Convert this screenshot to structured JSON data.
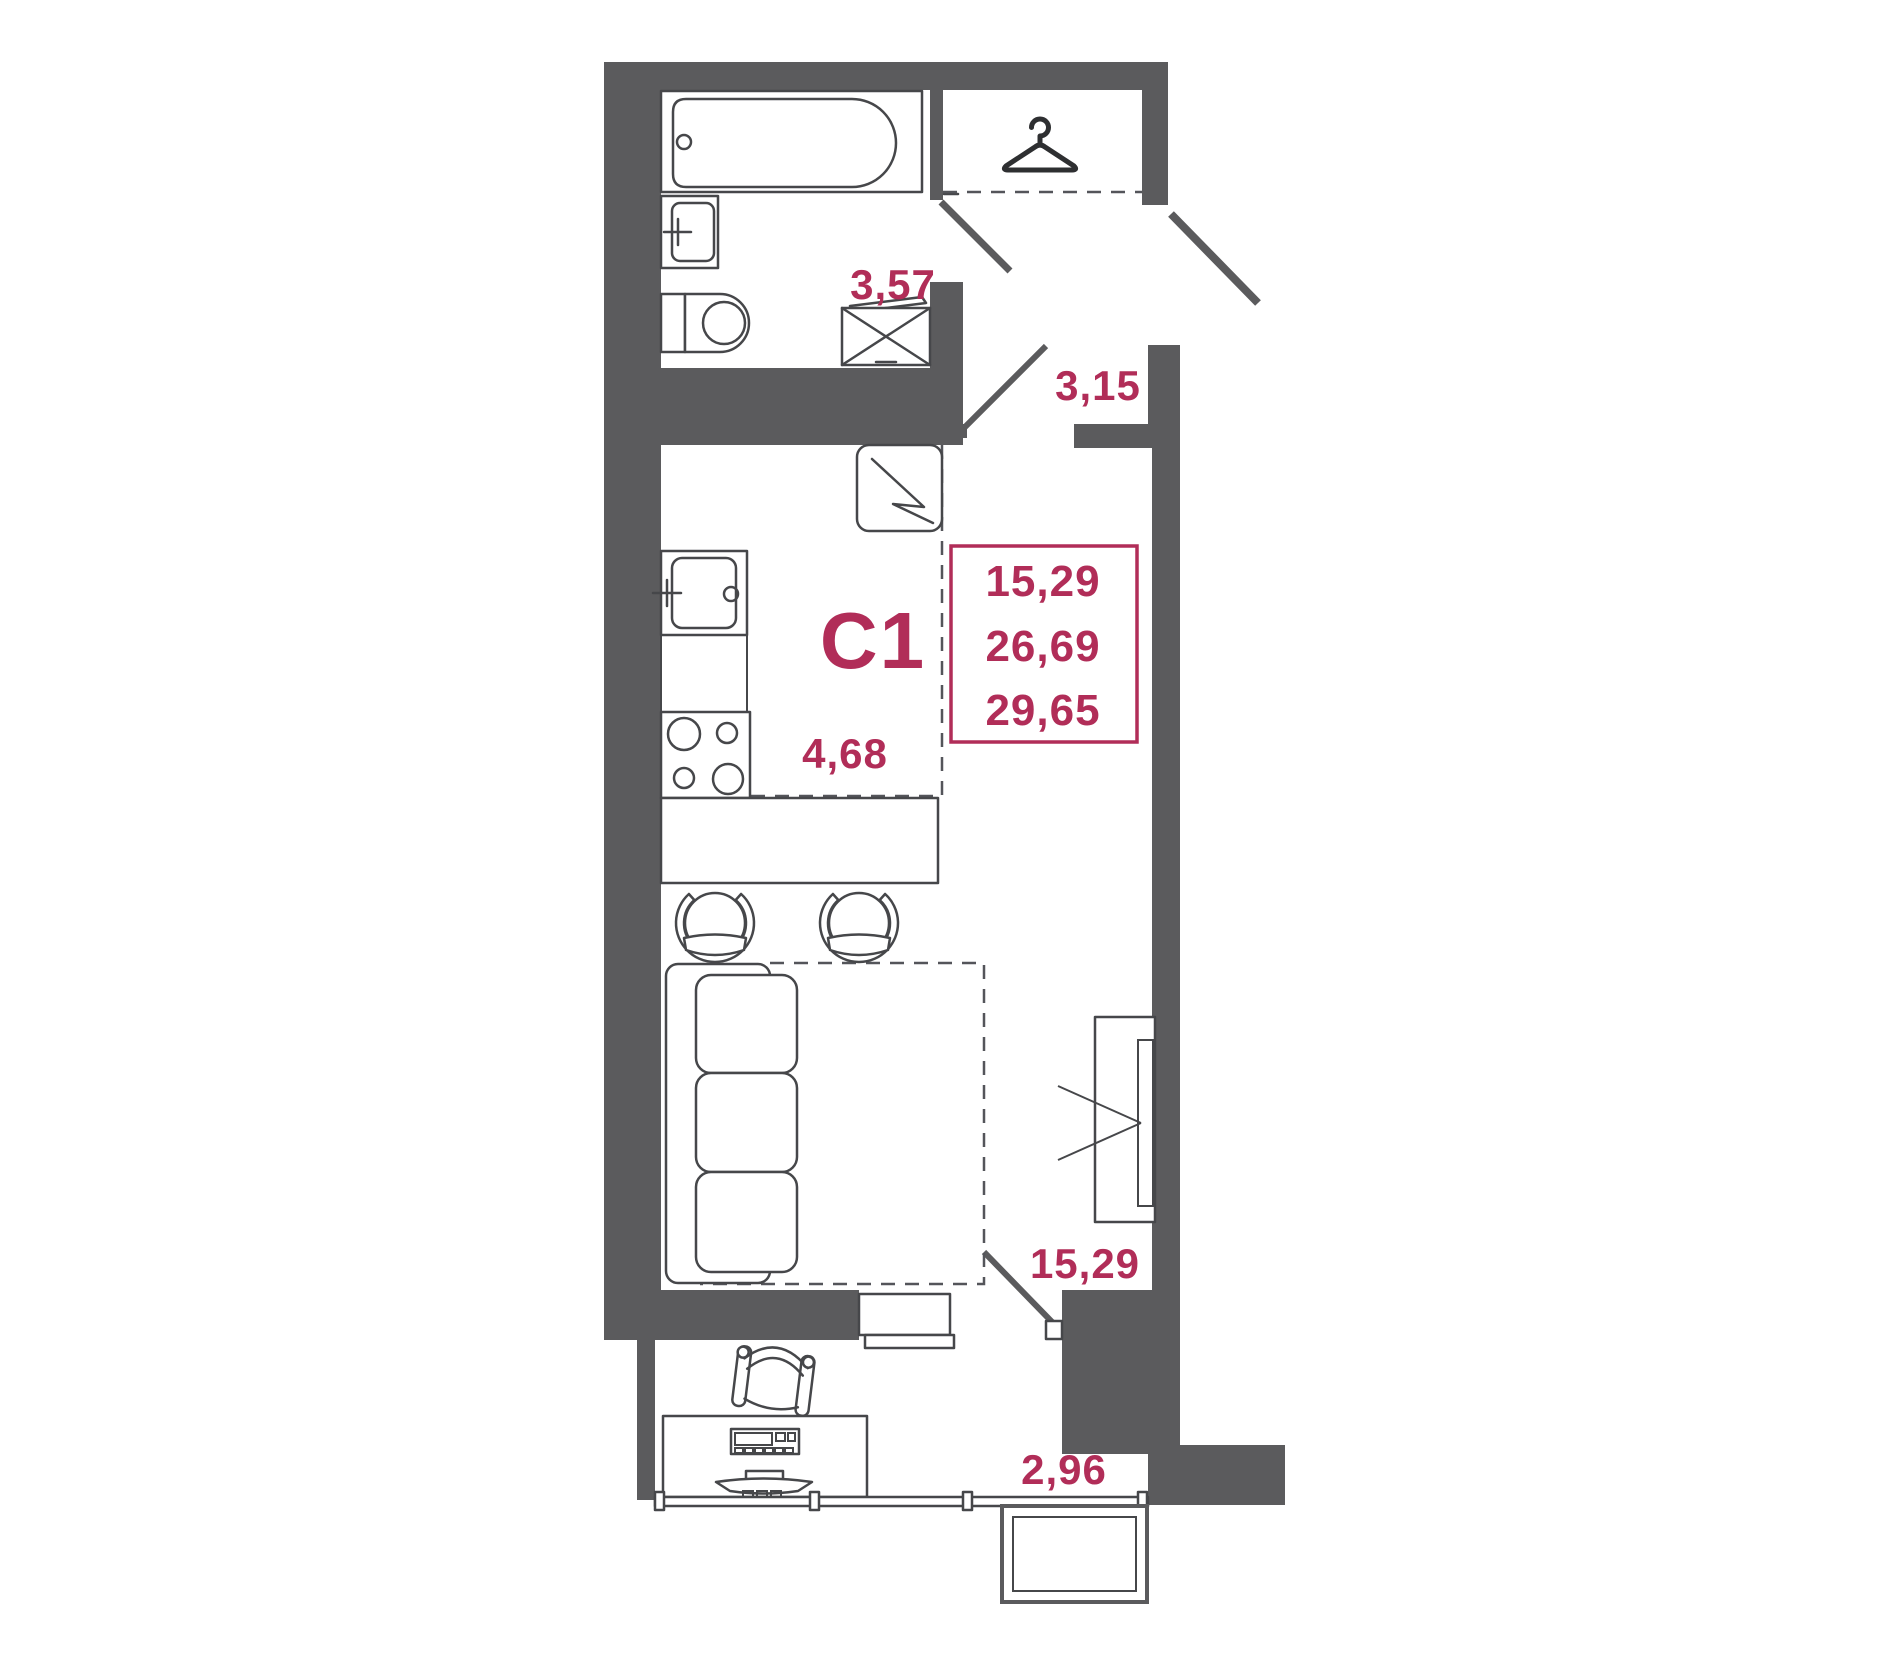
{
  "palette": {
    "wall": "#5b5b5d",
    "accent": "#b12d58",
    "fixture_line": "#46474a",
    "background": "#ffffff"
  },
  "unit": {
    "type_label": "C1",
    "area_values": [
      "15,29",
      "26,69",
      "29,65"
    ]
  },
  "rooms": {
    "bathroom": {
      "area": "3,57"
    },
    "hallway": {
      "area": "3,15"
    },
    "kitchen": {
      "area": "4,68"
    },
    "living": {
      "area": "15,29"
    },
    "balcony": {
      "area": "2,96"
    }
  },
  "icons": {
    "closet": "hanger-icon"
  }
}
